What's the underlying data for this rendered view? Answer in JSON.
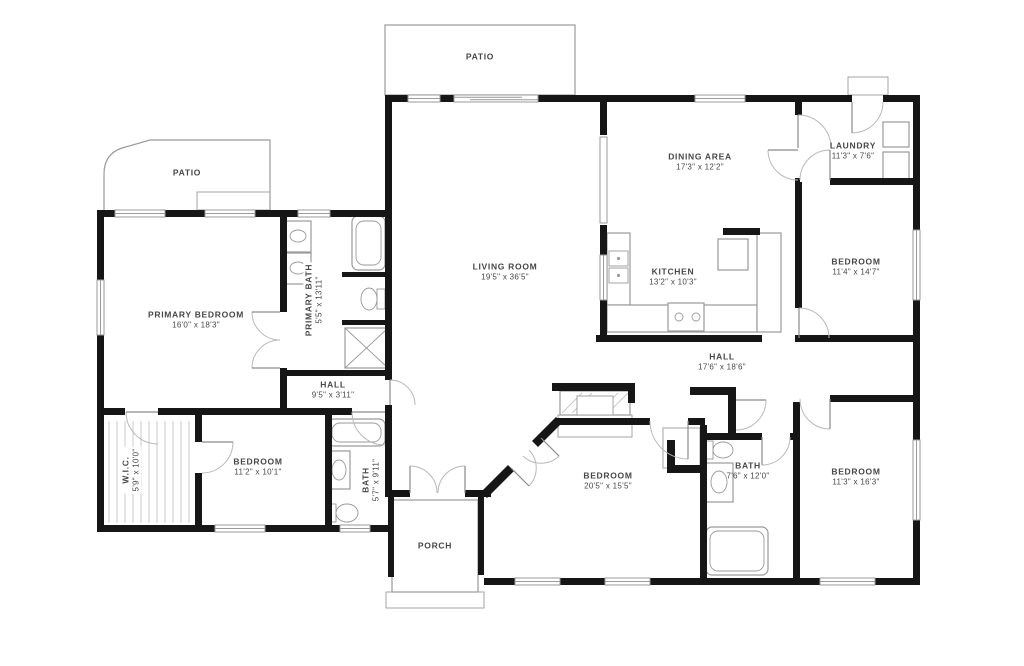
{
  "theme": {
    "wall": "#161616",
    "fixture": "#9a9a9a",
    "text": "#474747",
    "bg": "#ffffff"
  },
  "rooms": [
    {
      "name": "PATIO"
    },
    {
      "name": "PATIO"
    },
    {
      "name": "LIVING ROOM",
      "dims": "19'5\" x 36'5\""
    },
    {
      "name": "DINING AREA",
      "dims": "17'3\" x 12'2\""
    },
    {
      "name": "KITCHEN",
      "dims": "13'2\" x 10'3\""
    },
    {
      "name": "LAUNDRY",
      "dims": "11'3\" x 7'6\""
    },
    {
      "name": "BEDROOM",
      "dims": "11'4\" x 14'7\""
    },
    {
      "name": "PRIMARY BEDROOM",
      "dims": "16'0\" x 18'3\""
    },
    {
      "name": "PRIMARY BATH",
      "dims": "5'5\" x 13'11\""
    },
    {
      "name": "HALL",
      "dims": "9'5\" x 3'11\""
    },
    {
      "name": "W.I.C.",
      "dims": "5'9\" x 10'0\""
    },
    {
      "name": "BEDROOM",
      "dims": "11'2\" x 10'1\""
    },
    {
      "name": "BATH",
      "dims": "5'7\" x 9'11\""
    },
    {
      "name": "PORCH"
    },
    {
      "name": "BEDROOM",
      "dims": "20'5\" x 15'5\""
    },
    {
      "name": "HALL",
      "dims": "17'6\" x 18'6\""
    },
    {
      "name": "BATH",
      "dims": "7'6\" x 12'0\""
    },
    {
      "name": "BEDROOM",
      "dims": "11'3\" x 16'3\""
    }
  ]
}
